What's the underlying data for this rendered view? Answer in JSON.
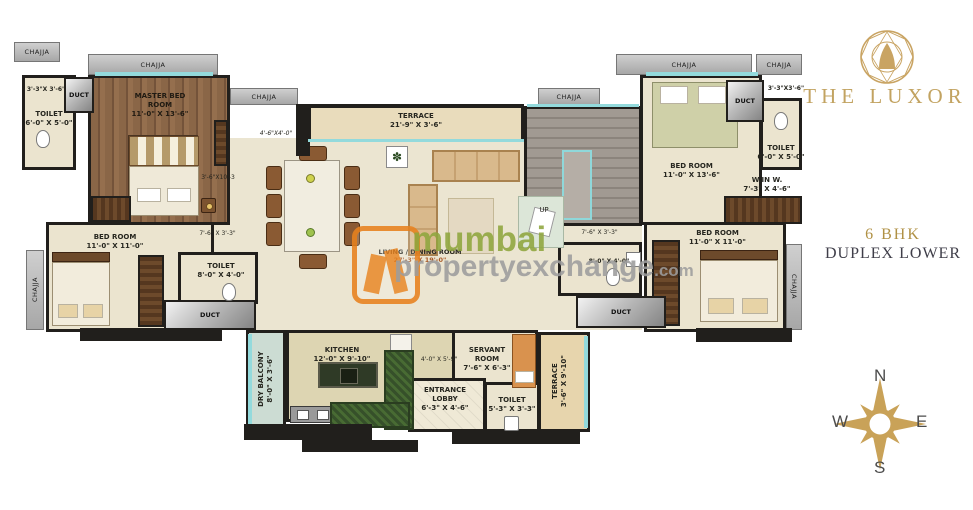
{
  "brand": {
    "name": "THE LUXOR",
    "gold": "#c2a361"
  },
  "unit": {
    "type": "6 BHK",
    "variant": "DUPLEX LOWER"
  },
  "compass": {
    "north": "N",
    "east": "E",
    "south": "S",
    "west": "W"
  },
  "watermark": {
    "word1": "mumbai",
    "word2": "propertyexchange",
    "tld": ".com",
    "orange": "#e8821e",
    "green": "#8fa63e",
    "gray": "#9d9d9d"
  },
  "common": {
    "chajja": "CHAJJA",
    "duct": "DUCT",
    "up": "UP"
  },
  "rooms": {
    "niche_top_left": {
      "dims": "3'-3\"X 3'-6\""
    },
    "toilet_top_left": {
      "name": "TOILET",
      "dims": "6'-0\" X 5'-0\""
    },
    "master_bedroom": {
      "name": "MASTER BED ROOM",
      "dims": "11'-0\" X 13'-6\""
    },
    "terrace_top": {
      "name": "TERRACE",
      "dims": "21'-9\" X 3'-6\""
    },
    "living_dining": {
      "name": "LIVING / DINING ROOM",
      "dims": "27'-3\" X 19'-0\""
    },
    "bedroom_left": {
      "name": "BED ROOM",
      "dims": "11'-0\" X 11'-0\""
    },
    "toilet_left": {
      "name": "TOILET",
      "dims": "8'-0\" X 4'-0\""
    },
    "bedroom_top_right": {
      "name": "BED ROOM",
      "dims": "11'-0\" X 13'-6\""
    },
    "niche_top_right": {
      "dims": "3'-3\"X3'-6\""
    },
    "toilet_top_right": {
      "name": "TOILET",
      "dims": "6'-0\" X 5'-0\""
    },
    "walk_in_wardrobe": {
      "name": "W.IN W.",
      "dims": "7'-3\" X 4'-6\""
    },
    "bedroom_right": {
      "name": "BED ROOM",
      "dims": "11'-0\" X 11'-0\""
    },
    "toilet_right": {
      "dims": "8'-0\" X 4'-0\""
    },
    "dry_balcony": {
      "name": "DRY BALCONY",
      "dims": "8'-0\" X 3'-6\""
    },
    "kitchen": {
      "name": "KITCHEN",
      "dims": "12'-0\" X 9'-10\""
    },
    "servant_room": {
      "name": "SERVANT ROOM",
      "dims": "7'-6\" X 6'-3\""
    },
    "entrance_lobby": {
      "name": "ENTRANCE LOBBY",
      "dims": "6'-3\" X 4'-6\""
    },
    "toilet_bottom": {
      "name": "TOILET",
      "dims": "5'-3\" X 3'-3\""
    },
    "terrace_bottom": {
      "name": "TERRACE",
      "dims": "3'-6\" X 9'-10\""
    },
    "staircase": {
      "name": "UP"
    }
  },
  "passages": {
    "p_master_hall": "4'-6\"X4'-0\"",
    "p_master_side": "3'-6\"X10'-3",
    "p_left": "7'-6\" X 3'-3\"",
    "p_right": "7'-6\" X 3'-3\"",
    "p_bottom": "4'-0\" X 5'-9\""
  }
}
